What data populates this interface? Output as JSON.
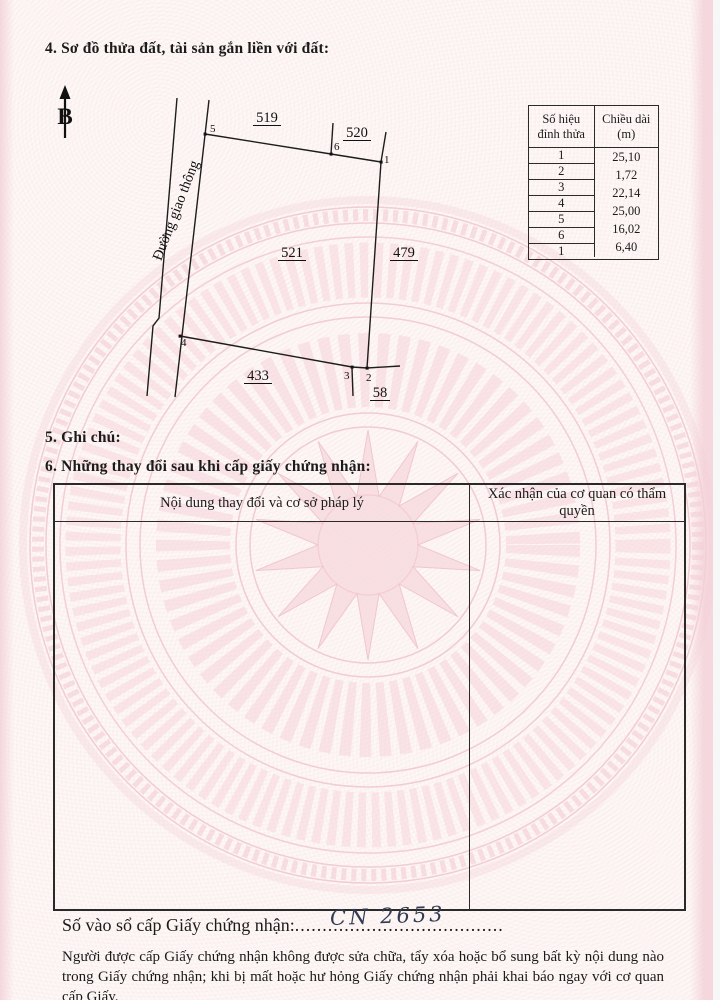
{
  "sections": {
    "sec4_title": "4. Sơ đồ thửa đất, tài sản gắn liền với đất:",
    "sec5_title": "5. Ghi chú:",
    "sec6_title": "6. Những thay đổi sau khi cấp giấy chứng nhận:"
  },
  "north_arrow": {
    "label": "B"
  },
  "diagram": {
    "road_label": "Đường giao thông",
    "parcel_labels": [
      "519",
      "520",
      "521",
      "479",
      "433",
      "58"
    ],
    "vertex_labels": [
      "1",
      "2",
      "3",
      "4",
      "5",
      "6"
    ]
  },
  "measure_table": {
    "col1_header": "Số hiệu đỉnh thửa",
    "col2_header": "Chiều dài (m)",
    "vertex_numbers": [
      "1",
      "2",
      "3",
      "4",
      "5",
      "6",
      "1"
    ],
    "lengths": [
      "25,10",
      "1,72",
      "22,14",
      "25,00",
      "16,02",
      "6,40"
    ]
  },
  "changes_table": {
    "col1_header": "Nội dung thay đổi và cơ sở pháp lý",
    "col2_header": "Xác nhận của cơ quan có thẩm quyền"
  },
  "register": {
    "label": "Số vào sổ cấp Giấy chứng nhận:",
    "dots_lead": "......",
    "dots_mid": "..............",
    "dots_tail": "..................",
    "value": "CN 2653"
  },
  "footer_note": "Người được cấp Giấy chứng nhận không được sửa chữa, tẩy xóa hoặc bổ sung bất kỳ nội dung nào trong Giấy chứng nhận; khi bị mất hoặc hư hỏng Giấy chứng nhận phải khai báo ngay với cơ quan cấp Giấy.",
  "colors": {
    "paper": "#fdf8f6",
    "watermark_pink": "#f3ccd3",
    "line": "#1d1d1d",
    "ink_handwriting": "#323b52"
  }
}
